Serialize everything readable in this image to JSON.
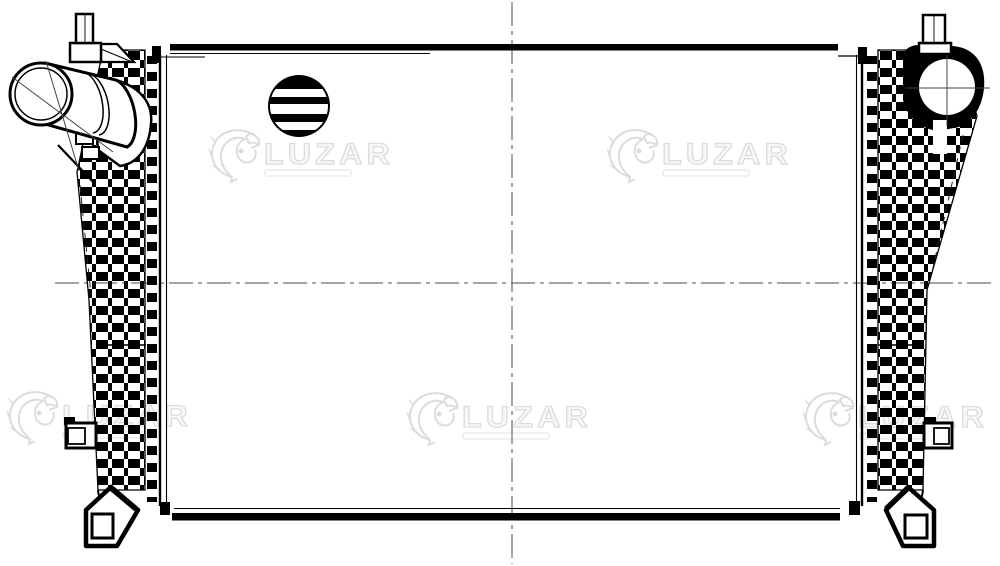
{
  "colors": {
    "background": "#ffffff",
    "ink": "#000000",
    "centerline": "#4a4a4a",
    "watermark": "#dcdcdc"
  },
  "watermark": {
    "brand": "LUZAR",
    "count": 5
  }
}
